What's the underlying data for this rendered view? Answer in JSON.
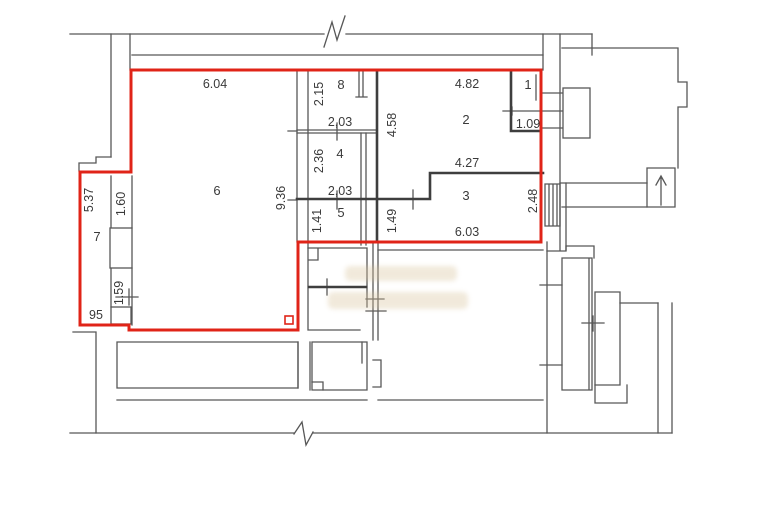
{
  "floor_plan": {
    "background_color": "#ffffff",
    "outline_color": "#e02418",
    "wall_color": "#575757",
    "wall_dark_color": "#3e3e3e",
    "text_color": "#3a3a3a",
    "watermark_color": "#d8c29a",
    "room_numbers": {
      "r1": "1",
      "r2": "2",
      "r3": "3",
      "r4": "4",
      "r5": "5",
      "r6": "6",
      "r7": "7",
      "r8": "8"
    },
    "dimensions": {
      "d604": "6.04",
      "d215": "2.15",
      "d203a": "2,03",
      "d458": "4.58",
      "d482": "4.82",
      "d109": "1.09",
      "d236": "2.36",
      "d936": "9.36",
      "d203b": "2,03",
      "d427": "4.27",
      "d248": "2.48",
      "d141": "1.41",
      "d149": "1.49",
      "d603": "6.03",
      "d537": "5.37",
      "d160": "1.60",
      "d159": "1.59",
      "d95": "95"
    }
  }
}
